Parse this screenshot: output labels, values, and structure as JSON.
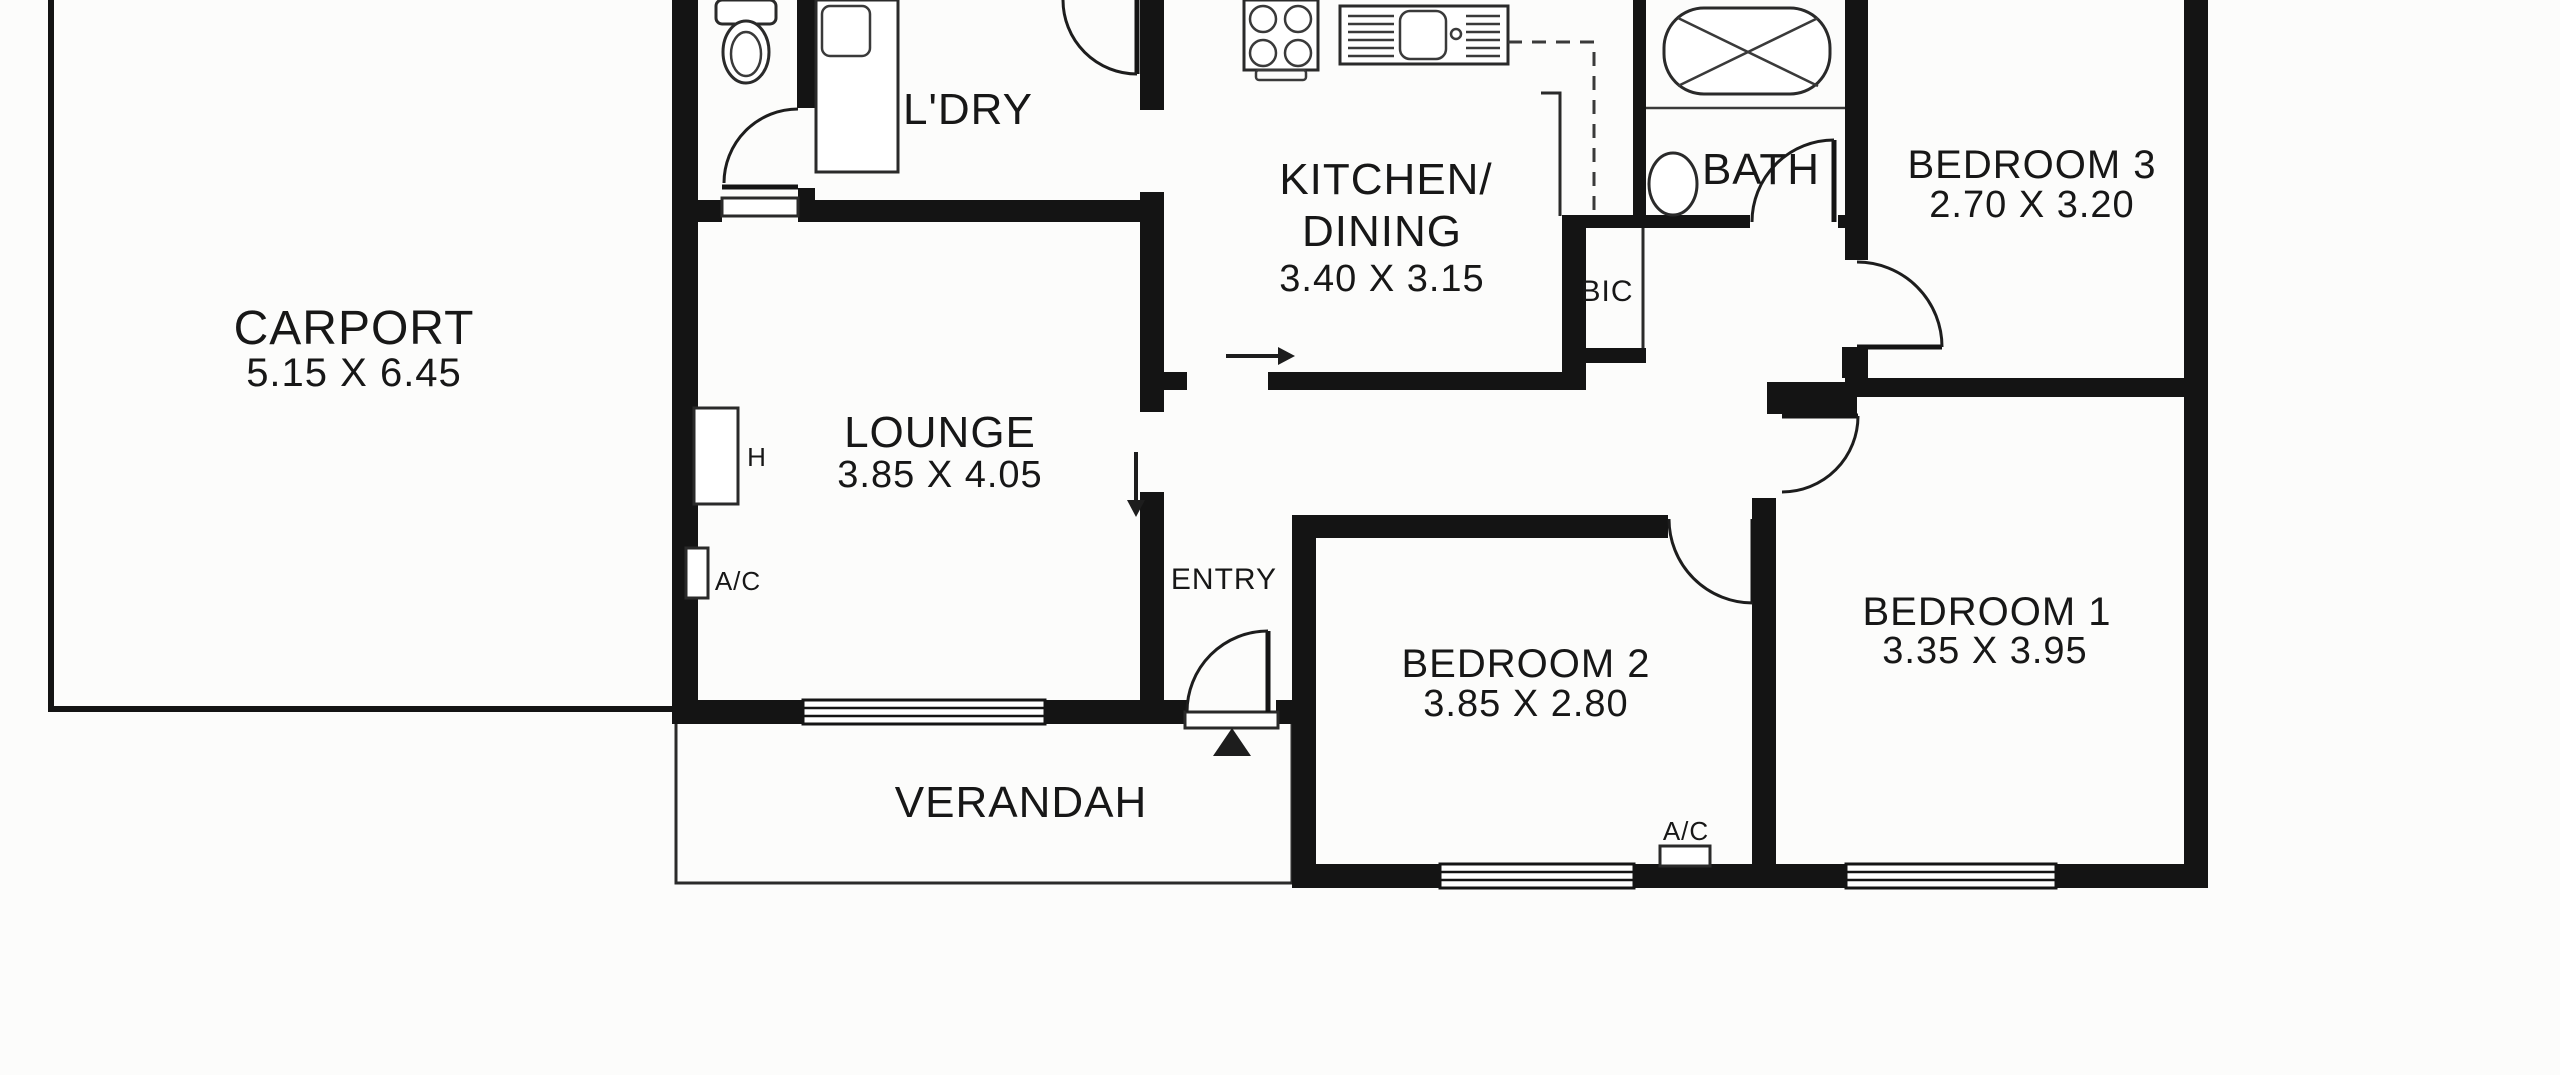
{
  "canvas": {
    "width": 2560,
    "height": 1075,
    "background_color": "#fcfcfb",
    "wall_color": "#141414",
    "text_color": "#171717"
  },
  "rooms": {
    "carport": {
      "name": "CARPORT",
      "dims": "5.15 X 6.45"
    },
    "laundry": {
      "name": "L'DRY"
    },
    "kitchen": {
      "name_line1": "KITCHEN/",
      "name_line2": "DINING",
      "dims": "3.40 X 3.15"
    },
    "bath": {
      "name": "BATH"
    },
    "bedroom3": {
      "name": "BEDROOM 3",
      "dims": "2.70 X 3.20"
    },
    "lounge": {
      "name": "LOUNGE",
      "dims": "3.85 X 4.05"
    },
    "entry": {
      "name": "ENTRY"
    },
    "bic": {
      "name": "BIC"
    },
    "bedroom2": {
      "name": "BEDROOM 2",
      "dims": "3.85 X 2.80"
    },
    "bedroom1": {
      "name": "BEDROOM 1",
      "dims": "3.35 X 3.95"
    },
    "verandah": {
      "name": "VERANDAH"
    }
  },
  "fixtures": {
    "heater": {
      "label": "H"
    },
    "ac_lounge": {
      "label": "A/C"
    },
    "ac_bedroom2": {
      "label": "A/C"
    }
  },
  "icons": {
    "toilet": "toilet-icon",
    "laundry_trough": "laundry-trough-icon",
    "cooktop": "cooktop-icon",
    "kitchen_sink": "kitchen-sink-icon",
    "bathtub": "bathtub-icon",
    "wash_basin": "wash-basin-icon",
    "fridge_space": "fridge-space-dashed-icon",
    "entry_arrow_right": "entry-direction-right-arrow-icon",
    "entry_arrow_down": "entry-direction-down-arrow-icon",
    "entry_marker": "entry-marker-triangle-icon",
    "door_swing": "door-swing-arc-icon",
    "window": "window-icon"
  }
}
